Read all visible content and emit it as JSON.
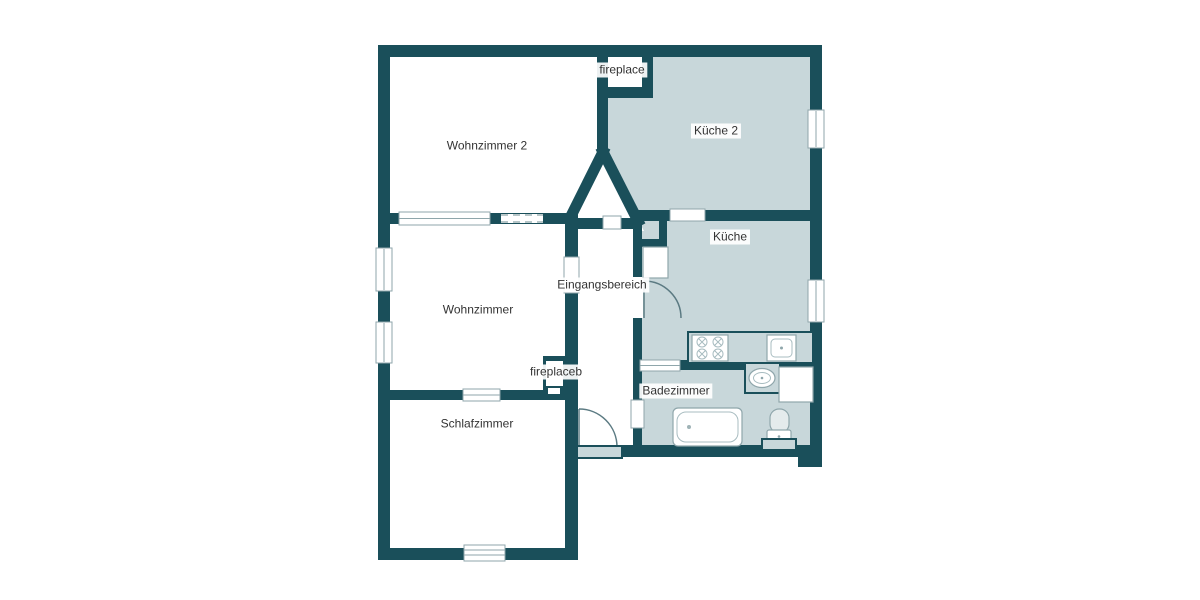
{
  "plan": {
    "rooms": [
      {
        "id": "wohnzimmer-2",
        "label": "Wohnzimmer 2"
      },
      {
        "id": "kueche-2",
        "label": "Küche 2"
      },
      {
        "id": "kueche",
        "label": "Küche"
      },
      {
        "id": "eingangsbereich",
        "label": "Eingangsbereich"
      },
      {
        "id": "wohnzimmer",
        "label": "Wohnzimmer"
      },
      {
        "id": "schlafzimmer",
        "label": "Schlafzimmer"
      },
      {
        "id": "badezimmer",
        "label": "Badezimmer"
      },
      {
        "id": "fireplace",
        "label": "fireplace"
      },
      {
        "id": "fireplaceb",
        "label": "fireplaceb"
      }
    ],
    "colors": {
      "wall": "#1a4f5a",
      "shaded_room": "#c8d7da",
      "unshaded_room": "#ffffff",
      "fixture_outline": "#8fa6ab",
      "label_text": "#333333",
      "background": "#ffffff"
    },
    "fixtures": [
      "stove-icon",
      "kitchen-sink-icon",
      "refrigerator-icon",
      "kitchen-counter",
      "bathtub-icon",
      "washbasin-icon",
      "toilet-icon",
      "washing-machine-icon",
      "entrance-door-icon",
      "kitchen-door-icon",
      "window-icon",
      "chimney-icon",
      "fireplace-niche-icon"
    ]
  }
}
